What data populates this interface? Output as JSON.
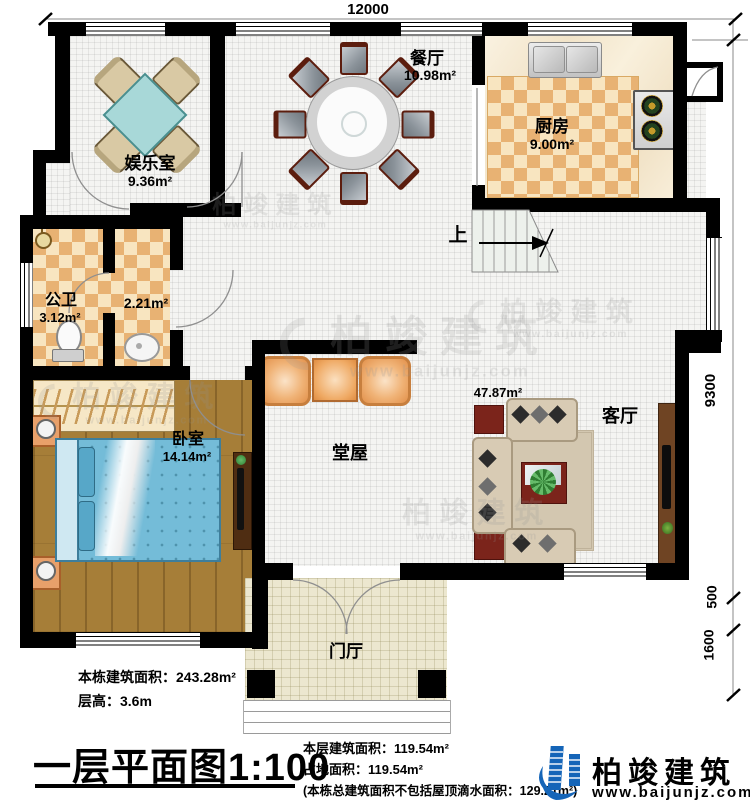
{
  "dimensions": {
    "top": "12000",
    "right": [
      "9300",
      "500",
      "1600"
    ]
  },
  "rooms": {
    "entertainment": {
      "name": "娱乐室",
      "area": "9.36m²"
    },
    "dining": {
      "name": "餐厅",
      "area": "10.98m²"
    },
    "kitchen": {
      "name": "厨房",
      "area": "9.00m²"
    },
    "bathroom": {
      "name": "公卫",
      "area": "3.12m²"
    },
    "washroom": {
      "area": "2.21m²"
    },
    "bedroom": {
      "name": "卧室",
      "area": "14.14m²"
    },
    "hall": {
      "name": "堂屋"
    },
    "living": {
      "name": "客厅",
      "area": "47.87m²"
    },
    "foyer": {
      "name": "门厅"
    },
    "stairs": {
      "up_label": "上"
    }
  },
  "notes_left": {
    "building_area": "本栋建筑面积：243.28m²",
    "floor_height": "层高：3.6m"
  },
  "title": "一层平面图1:100",
  "notes_center": {
    "floor_area": "本层建筑面积：119.54m²",
    "footprint": "占地面积：119.54m²",
    "note": "(本栋总建筑面积不包括屋顶滴水面积：129.21m²)"
  },
  "brand": {
    "name": "柏竣建筑",
    "site": "www.baijunjz.com"
  },
  "watermark": {
    "name": "柏竣建筑",
    "site": "www.baijunjz.com"
  },
  "colors": {
    "brand_blue": "#1565b8",
    "wall_black": "#000000",
    "checker_tan": "#e8b273"
  }
}
